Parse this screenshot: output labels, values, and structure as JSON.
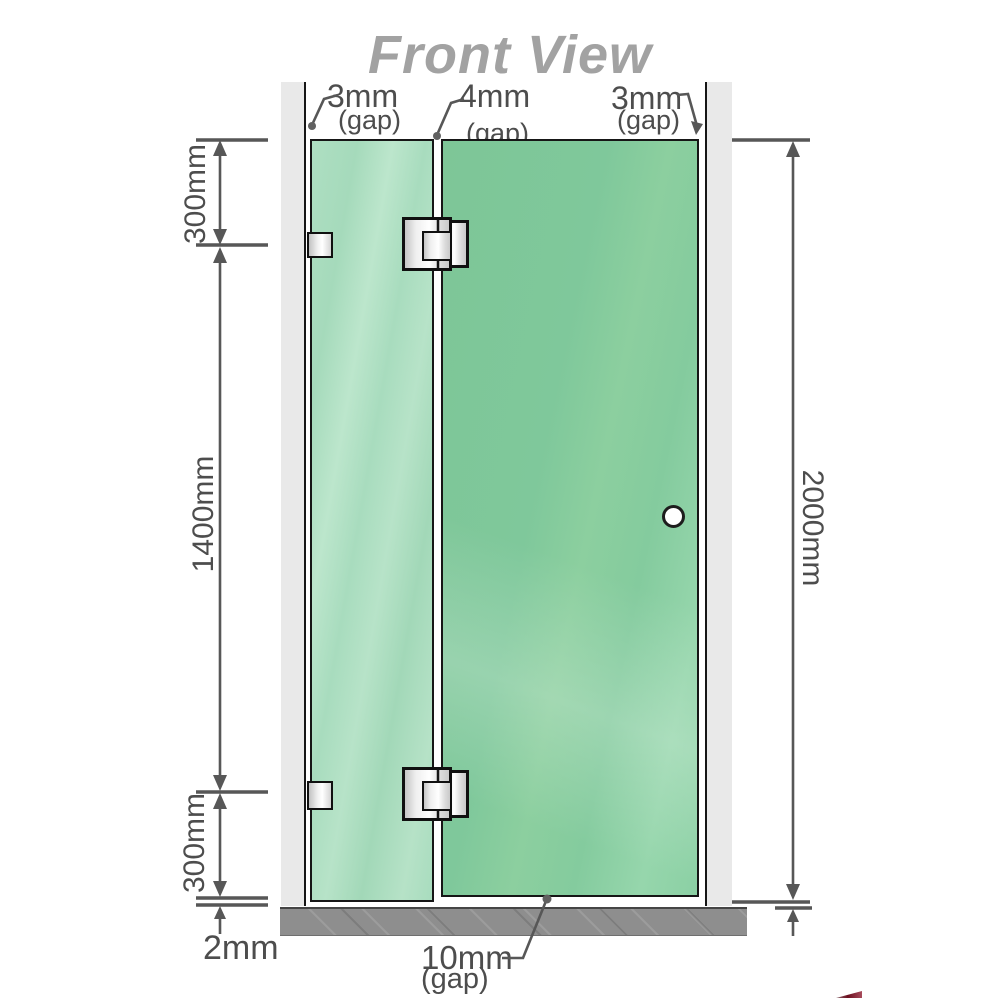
{
  "title": "Front View",
  "annotations": {
    "gap_top_left": {
      "value": "3mm",
      "note": "(gap)"
    },
    "gap_top_middle": {
      "value": "4mm",
      "note": "(gap)"
    },
    "gap_top_right": {
      "value": "3mm",
      "note": "(gap)"
    },
    "gap_bottom": {
      "value": "10mm",
      "note": "(gap)"
    },
    "segment_top": "300mm",
    "segment_middle": "1400mm",
    "segment_bottom": "300mm",
    "floor_clearance": "2mm",
    "overall_height": "2000mm"
  },
  "components": {
    "left_wall": "wall strip",
    "right_wall": "wall strip",
    "left_fixed_glass_panel": "fixed glass panel",
    "right_glass_door_panel": "hinged glass door panel",
    "hinges": [
      "glass-to-glass hinge top",
      "glass-to-glass hinge bottom"
    ],
    "wall_brackets": [
      "wall bracket top",
      "wall bracket bottom"
    ],
    "door_knob": "round door knob",
    "floor": "floor slab"
  },
  "colors": {
    "glass_left_panel": "#a8dcbe",
    "glass_right_panel": "#82c99d",
    "wall": "#e9e9e9",
    "floor": "#8e8e8e",
    "dimension_line": "#575757",
    "label_text": "#4d4d4d",
    "title_text": "#a2a2a2",
    "outline": "#161616",
    "hardware_fill": "#f0f0f0"
  }
}
